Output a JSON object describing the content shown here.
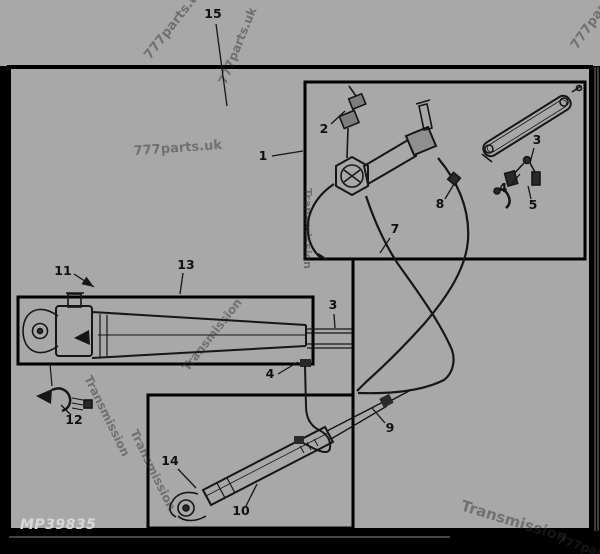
{
  "diagram": {
    "label": "MP39835",
    "colors": {
      "field": "#a8a8a8",
      "frame": "#000000",
      "ink": "#161616",
      "label_text": "#d8d8d8",
      "watermark": "#2e2e2e"
    },
    "callouts": [
      {
        "label": "15",
        "x": 213,
        "y": 18,
        "leader": [
          216,
          24,
          227,
          106
        ]
      },
      {
        "label": "1",
        "x": 263,
        "y": 160,
        "leader": [
          272,
          156,
          303,
          151
        ]
      },
      {
        "label": "2",
        "x": 324,
        "y": 133,
        "leader": [
          331,
          124,
          345,
          111
        ]
      },
      {
        "label": "3",
        "x": 537,
        "y": 144,
        "leader": [
          534,
          148,
          530,
          163
        ]
      },
      {
        "label": "4",
        "x": 503,
        "y": 192,
        "leader": [
          510,
          186,
          520,
          174
        ]
      },
      {
        "label": "5",
        "x": 533,
        "y": 209,
        "leader": [
          531,
          199,
          528,
          186
        ]
      },
      {
        "label": "7",
        "x": 395,
        "y": 233,
        "leader": [
          390,
          238,
          380,
          253
        ]
      },
      {
        "label": "8",
        "x": 440,
        "y": 208,
        "leader": [
          445,
          199,
          454,
          184
        ]
      },
      {
        "label": "3",
        "x": 333,
        "y": 309,
        "leader": [
          334,
          314,
          335,
          328
        ]
      },
      {
        "label": "4",
        "x": 270,
        "y": 378,
        "leader": [
          278,
          374,
          298,
          362
        ]
      },
      {
        "label": "9",
        "x": 390,
        "y": 432,
        "leader": [
          385,
          423,
          372,
          408
        ]
      },
      {
        "label": "10",
        "x": 241,
        "y": 515,
        "leader": [
          246,
          506,
          257,
          484
        ]
      },
      {
        "label": "11",
        "x": 63,
        "y": 275,
        "leader": [
          74,
          274,
          94,
          287
        ],
        "arrow": true
      },
      {
        "label": "12",
        "x": 74,
        "y": 424,
        "leader": [
          71,
          415,
          61,
          405
        ]
      },
      {
        "label": "13",
        "x": 186,
        "y": 269,
        "leader": [
          183,
          273,
          180,
          294
        ]
      },
      {
        "label": "14",
        "x": 170,
        "y": 465,
        "leader": [
          178,
          469,
          196,
          488
        ]
      }
    ],
    "watermarks": [
      {
        "text": "777parts.uk",
        "x": 150,
        "y": 60,
        "rotate": -52,
        "size": 13
      },
      {
        "text": "777parts.uk",
        "x": 226,
        "y": 85,
        "rotate": -68,
        "size": 12
      },
      {
        "text": "777parts.uk",
        "x": 577,
        "y": 50,
        "rotate": -55,
        "size": 13
      },
      {
        "text": "777parts.uk",
        "x": 134,
        "y": 155,
        "rotate": -4,
        "size": 13
      },
      {
        "text": "Transmission",
        "x": 304,
        "y": 188,
        "rotate": 90,
        "size": 11
      },
      {
        "text": "Transmission",
        "x": 188,
        "y": 372,
        "rotate": -52,
        "size": 12
      },
      {
        "text": "Transmission",
        "x": 84,
        "y": 378,
        "rotate": 64,
        "size": 12
      },
      {
        "text": "Transmission",
        "x": 130,
        "y": 432,
        "rotate": 64,
        "size": 12
      },
      {
        "text": "Transmission",
        "x": 460,
        "y": 510,
        "rotate": 17,
        "size": 15
      },
      {
        "text": "777parts.uk",
        "x": 556,
        "y": 543,
        "rotate": 17,
        "size": 12
      }
    ]
  }
}
